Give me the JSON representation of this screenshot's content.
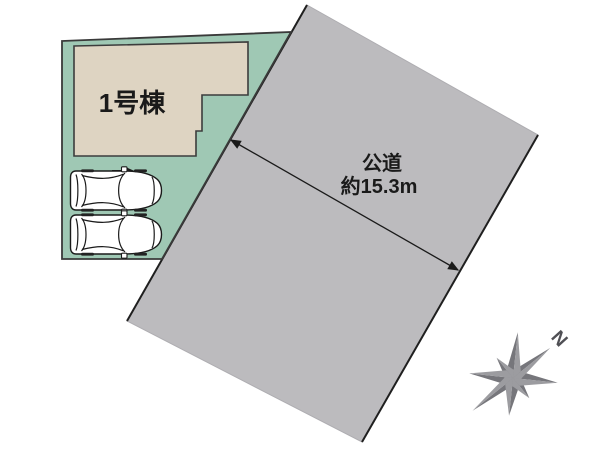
{
  "labels": {
    "building": "1号棟",
    "road_type": "公道",
    "road_width": "約15.3m",
    "north": "N"
  },
  "values": {
    "building_number": 1,
    "road_width_m": 15.3,
    "parking_spaces": 2
  },
  "colors": {
    "background": "#ffffff",
    "lot": "#9fc8b4",
    "lot_border": "#3a3a3a",
    "building": "#ded4c2",
    "building_border": "#3c3c3c",
    "road": "#bcbbbe",
    "road_soft_edge": "#aeadb1",
    "road_border": "#1f1f1f",
    "dimension": "#1a1a1a",
    "text": "#1a1a1a",
    "car_body": "#ffffff",
    "car_outline": "#1a1a1a",
    "car_wheel": "#222222",
    "compass_dark": "#76767b",
    "compass_light": "#9c9ca0",
    "compass_text": "#505055"
  }
}
